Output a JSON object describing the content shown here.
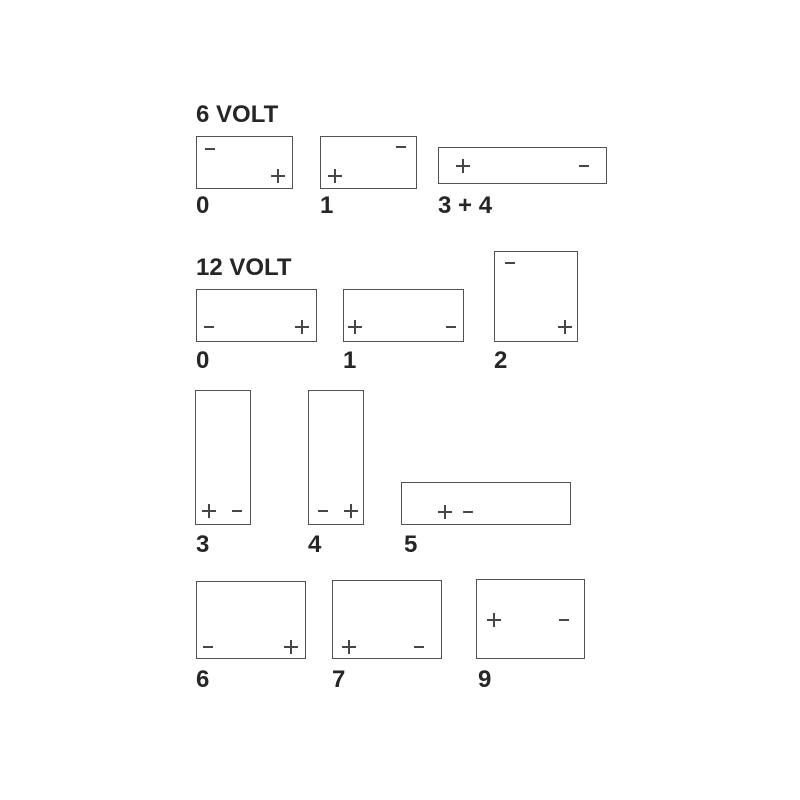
{
  "diagram_type": "battery-terminal-layout",
  "colors": {
    "background": "#ffffff",
    "outline": "#525252",
    "terminal_mark": "#474747",
    "text": "#262626"
  },
  "sections": [
    {
      "title": "6 VOLT",
      "boxes": [
        {
          "label": "0",
          "terminals": [
            {
              "polarity": "minus",
              "symbol": "−",
              "position": "top-left"
            },
            {
              "polarity": "plus",
              "symbol": "+",
              "position": "bottom-right"
            }
          ]
        },
        {
          "label": "1",
          "terminals": [
            {
              "polarity": "minus",
              "symbol": "−",
              "position": "top-right"
            },
            {
              "polarity": "plus",
              "symbol": "+",
              "position": "bottom-left"
            }
          ]
        },
        {
          "label": "3 + 4",
          "terminals": [
            {
              "polarity": "plus",
              "symbol": "+",
              "position": "middle-left"
            },
            {
              "polarity": "minus",
              "symbol": "−",
              "position": "middle-right"
            }
          ]
        }
      ]
    },
    {
      "title": "12 VOLT",
      "boxes": [
        {
          "label": "0",
          "terminals": [
            {
              "polarity": "minus",
              "symbol": "−",
              "position": "bottom-left"
            },
            {
              "polarity": "plus",
              "symbol": "+",
              "position": "bottom-right"
            }
          ]
        },
        {
          "label": "1",
          "terminals": [
            {
              "polarity": "plus",
              "symbol": "+",
              "position": "bottom-left"
            },
            {
              "polarity": "minus",
              "symbol": "−",
              "position": "bottom-right"
            }
          ]
        },
        {
          "label": "2",
          "terminals": [
            {
              "polarity": "minus",
              "symbol": "−",
              "position": "top-left"
            },
            {
              "polarity": "plus",
              "symbol": "+",
              "position": "bottom-right"
            }
          ]
        },
        {
          "label": "3",
          "terminals": [
            {
              "polarity": "plus",
              "symbol": "+",
              "position": "bottom-left"
            },
            {
              "polarity": "minus",
              "symbol": "−",
              "position": "bottom-right"
            }
          ]
        },
        {
          "label": "4",
          "terminals": [
            {
              "polarity": "minus",
              "symbol": "−",
              "position": "bottom-left"
            },
            {
              "polarity": "plus",
              "symbol": "+",
              "position": "bottom-right"
            }
          ]
        },
        {
          "label": "5",
          "terminals": [
            {
              "polarity": "plus",
              "symbol": "+",
              "position": "left-inner"
            },
            {
              "polarity": "minus",
              "symbol": "−",
              "position": "left-inner-right"
            }
          ]
        },
        {
          "label": "6",
          "terminals": [
            {
              "polarity": "minus",
              "symbol": "−",
              "position": "bottom-left"
            },
            {
              "polarity": "plus",
              "symbol": "+",
              "position": "bottom-right"
            }
          ]
        },
        {
          "label": "7",
          "terminals": [
            {
              "polarity": "plus",
              "symbol": "+",
              "position": "bottom-left"
            },
            {
              "polarity": "minus",
              "symbol": "−",
              "position": "bottom-right"
            }
          ]
        },
        {
          "label": "9",
          "terminals": [
            {
              "polarity": "plus",
              "symbol": "+",
              "position": "middle-left"
            },
            {
              "polarity": "minus",
              "symbol": "−",
              "position": "middle-right"
            }
          ]
        }
      ]
    }
  ]
}
